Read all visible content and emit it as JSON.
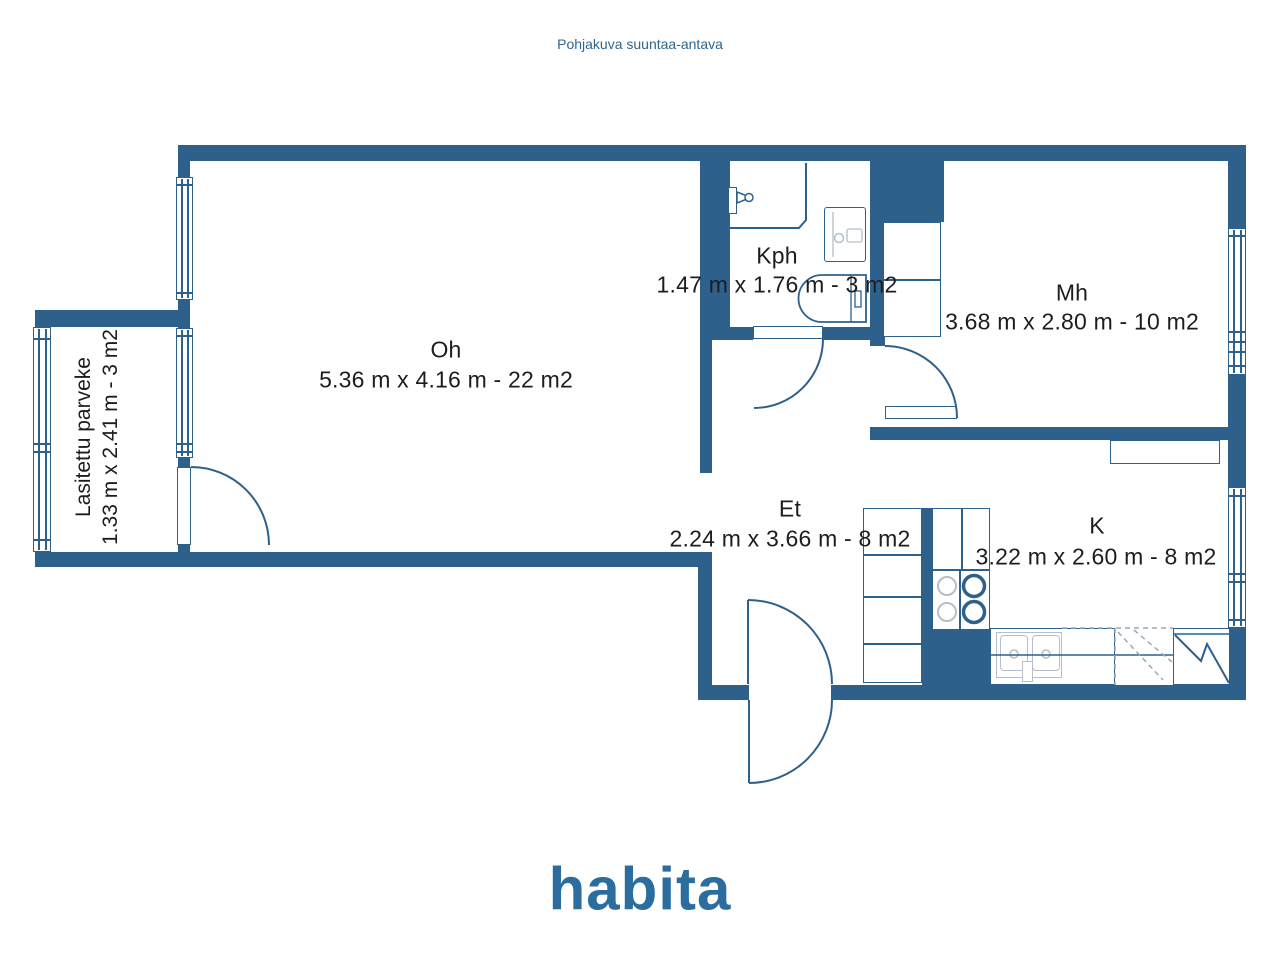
{
  "title": "Pohjakuva suuntaa-antava",
  "brand": "habita",
  "rooms": {
    "oh": {
      "label": "Oh",
      "dims": "5.36 m x 4.16 m - 22 m2"
    },
    "kph": {
      "label": "Kph",
      "dims": "1.47 m x 1.76 m - 3 m2"
    },
    "mh": {
      "label": "Mh",
      "dims": "3.68 m x 2.80 m - 10 m2"
    },
    "et": {
      "label": "Et",
      "dims": "2.24 m x 3.66 m - 8 m2"
    },
    "k": {
      "label": "K",
      "dims": "3.22 m x 2.60 m - 8 m2"
    },
    "parveke": {
      "label": "Lasitettu parveke",
      "dims": "1.33 m x 2.41 m - 3 m2"
    }
  },
  "colors": {
    "wall": "#2e608c",
    "fixture_light": "#b4bfc9",
    "room_text": "#1d1d1f",
    "title_text": "#2f6690",
    "logo": "#2a6d9e"
  }
}
